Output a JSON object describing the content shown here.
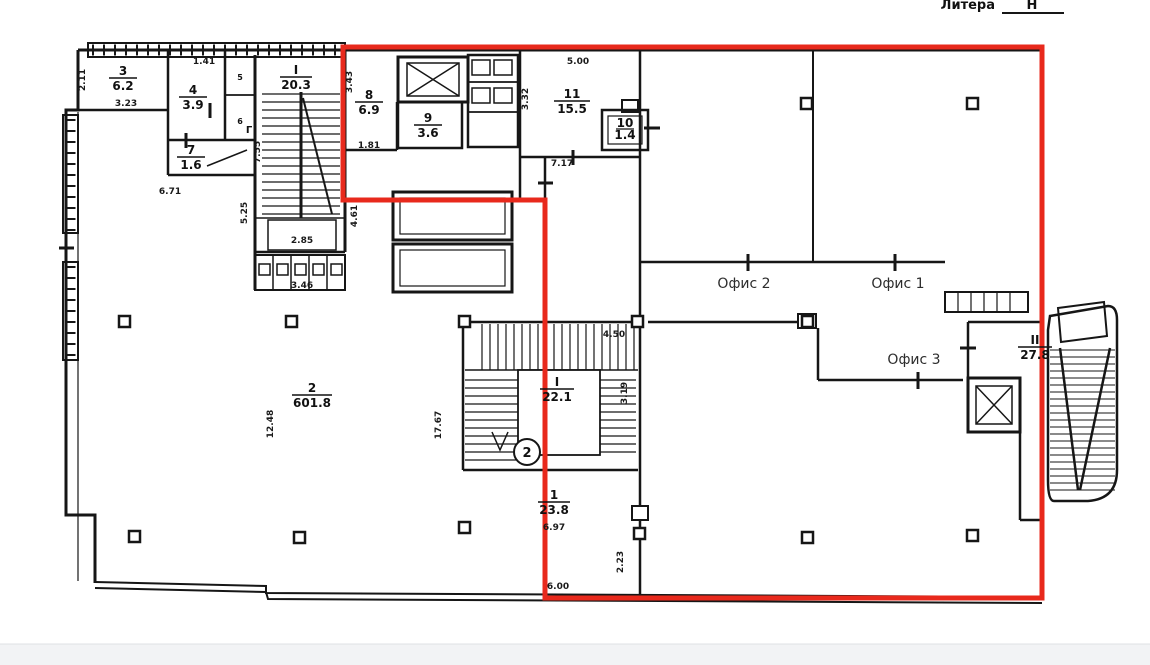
{
  "page": {
    "litera_label": "Литера",
    "litera_value": "Н"
  },
  "rooms": {
    "r3": {
      "num": "3",
      "area": "6.2"
    },
    "r4": {
      "num": "4",
      "area": "3.9"
    },
    "r5": {
      "num": "5"
    },
    "r6": {
      "num": "6"
    },
    "r7": {
      "num": "7",
      "area": "1.6"
    },
    "rI": {
      "num": "I",
      "area": "20.3"
    },
    "r8": {
      "num": "8",
      "area": "6.9"
    },
    "r9": {
      "num": "9",
      "area": "3.6"
    },
    "r10": {
      "num": "10",
      "area": "1.4"
    },
    "r11": {
      "num": "11",
      "area": "15.5"
    },
    "r2": {
      "num": "2",
      "area": "601.8"
    },
    "rs": {
      "num": "I",
      "area": "22.1"
    },
    "r1": {
      "num": "1",
      "area": "23.8"
    },
    "rII": {
      "num": "II",
      "area": "27.8"
    }
  },
  "offices": {
    "office1": "Офис 1",
    "office2": "Офис 2",
    "office3": "Офис 3"
  },
  "annotations": {
    "floor_marker": "2",
    "corridor_letter": "Г"
  },
  "dimensions": {
    "d2_11": "2.11",
    "d3_23": "3.23",
    "d1_41": "1.41",
    "d7_55": "7.55",
    "d5_25": "5.25",
    "d2_85": "2.85",
    "d3_46": "3.46",
    "d4_61": "4.61",
    "d6_71": "6.71",
    "d3_43": "3.43",
    "d1_81": "1.81",
    "d5_00": "5.00",
    "d3_32": "3.32",
    "d7_17": "7.17",
    "d12_48": "12.48",
    "d17_67": "17.67",
    "d4_50": "4.50",
    "d3_19": "3.19",
    "d6_97": "6.97",
    "d6_00": "6.00",
    "d2_23": "2.23"
  },
  "colors": {
    "highlight": "#e8291c",
    "wall": "#161616"
  }
}
